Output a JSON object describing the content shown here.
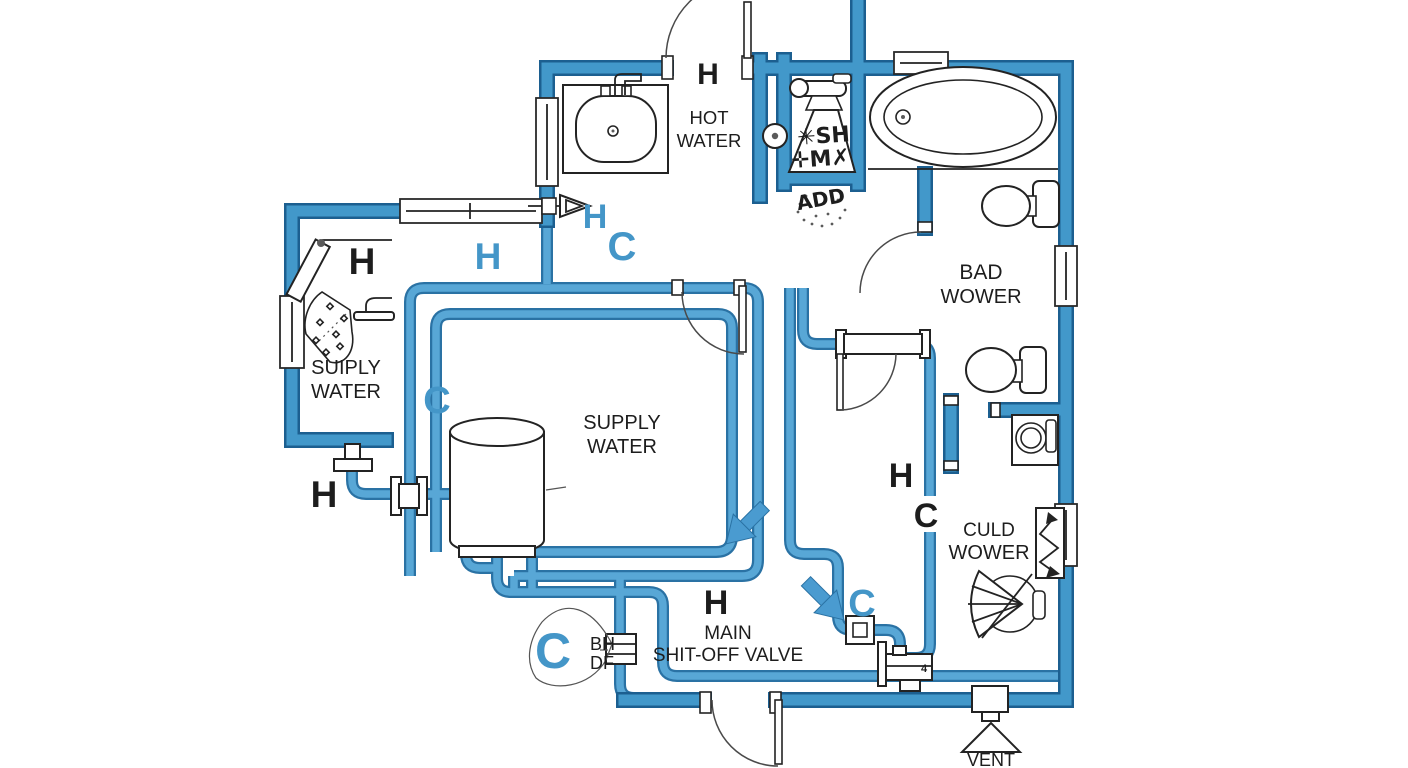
{
  "diagram": {
    "type": "plumbing-floor-plan",
    "colors": {
      "wall": "#4298ca",
      "wall_outline": "#1c5f90",
      "pipe": "#58a7d6",
      "pipe_outline": "#2a72a4",
      "label_black": "#1d1d1d",
      "label_blue": "#4496c8",
      "background": "#ffffff"
    },
    "fixtures": [
      "sink",
      "shower-mixer",
      "wall-dial",
      "bathtub",
      "toilet",
      "toilet-2",
      "washing-machine",
      "zigzag-valve",
      "fan-shower",
      "shower-head",
      "water-heater",
      "hose-bib",
      "tee-valve",
      "union-fitting",
      "pipe-union",
      "square-valve",
      "pipe-coupling",
      "main-shut-off-valve",
      "vent-cone",
      "door",
      "window"
    ]
  },
  "labels": {
    "entry_h": "H",
    "hot_water_line1": "HOT",
    "hot_water_line2": "WATER",
    "cone_line1": "✳SH",
    "cone_line2": "✛M✗",
    "add_note": "ADD",
    "bath_line1": "BAD",
    "bath_line2": "WOWER",
    "left_h": "H",
    "left_supply_line1": "SUIPLY",
    "left_supply_line2": "WATER",
    "hall_h_blue": "H",
    "entry_h_blue": "H",
    "entry_c_blue": "C",
    "loop_c_blue": "C",
    "center_supply_line1": "SUPPLY",
    "center_supply_line2": "WATER",
    "heater_h": "H",
    "riser_h": "H",
    "riser_c": "C",
    "cold_line1": "CULD",
    "cold_line2": "WOWER",
    "shutoff_h": "H",
    "shutoff_line1": "MAIN",
    "shutoff_line2": "SHIT-OFF VALVE",
    "branch_c_blue": "C",
    "drain_c_blue": "C",
    "drain_line1": "BH",
    "drain_line2": "DF",
    "vent": "VENT",
    "valve_number": "4"
  }
}
